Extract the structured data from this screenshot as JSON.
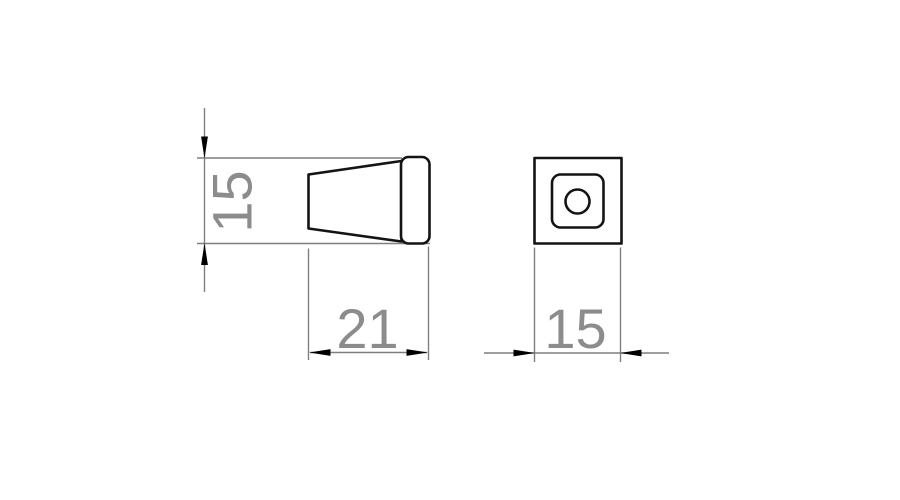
{
  "drawing": {
    "colors": {
      "background": "#ffffff",
      "part_outline": "#141414",
      "dimension_lines": "#7f7f7f",
      "dimension_text": "#8c8c8c",
      "arrowheads": "#000000"
    },
    "views": {
      "side": {
        "dimensions": {
          "height": "15",
          "length": "21"
        }
      },
      "front": {
        "dimensions": {
          "width": "15"
        }
      }
    }
  }
}
